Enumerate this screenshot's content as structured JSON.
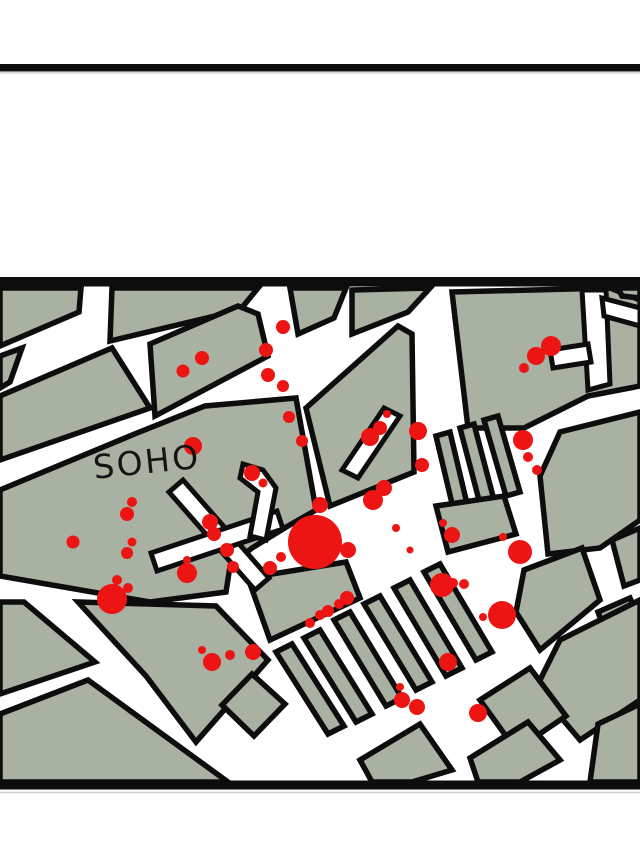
{
  "page": {
    "width": 640,
    "height": 853,
    "background": "#ffffff"
  },
  "colors": {
    "block_fill": "#a9b1a3",
    "outline": "#0d0d0d",
    "street": "#ffffff",
    "death_dot": "#ed1414",
    "rule_shadow": "#cccccc",
    "label_text": "#141414"
  },
  "rules": [
    {
      "name": "page-top-rule",
      "x": 0,
      "y": 64,
      "w": 640,
      "h": 7.5,
      "color": "#0d0d0d"
    },
    {
      "name": "page-top-rule-shadow",
      "x": 0,
      "y": 72.2,
      "w": 640,
      "h": 1.3,
      "color": "#cccccc"
    },
    {
      "name": "map-top-border",
      "x": 0,
      "y": 277,
      "w": 640,
      "h": 9.5,
      "color": "#0d0d0d"
    },
    {
      "name": "map-bottom-border",
      "x": 0,
      "y": 780.5,
      "w": 640,
      "h": 9,
      "color": "#0d0d0d"
    },
    {
      "name": "map-bottom-border-shadow",
      "x": 0,
      "y": 791.8,
      "w": 640,
      "h": 1.4,
      "color": "#cccccc"
    }
  ],
  "map": {
    "label": {
      "text": "SOHO",
      "x": 93,
      "y": 474,
      "font_size": 33,
      "rotation": -6,
      "rotate_cx": 140,
      "rotate_cy": 462
    },
    "block_stroke_width": 5.5,
    "street_stroke_width": 5,
    "blocks": [
      [
        [
          0,
          288
        ],
        [
          81,
          288
        ],
        [
          79,
          312
        ],
        [
          0,
          346
        ]
      ],
      [
        [
          0,
          356
        ],
        [
          22,
          348
        ],
        [
          10,
          382
        ],
        [
          0,
          388
        ]
      ],
      [
        [
          112,
          288
        ],
        [
          258,
          288
        ],
        [
          240,
          310
        ],
        [
          110,
          341
        ]
      ],
      [
        [
          290,
          288
        ],
        [
          346,
          288
        ],
        [
          334,
          318
        ],
        [
          298,
          334
        ]
      ],
      [
        [
          352,
          290
        ],
        [
          430,
          288
        ],
        [
          408,
          312
        ],
        [
          352,
          334
        ]
      ],
      [
        [
          452,
          292
        ],
        [
          610,
          288
        ],
        [
          640,
          300
        ],
        [
          640,
          386
        ],
        [
          588,
          396
        ],
        [
          524,
          428
        ],
        [
          468,
          428
        ]
      ],
      [
        [
          618,
          288
        ],
        [
          640,
          288
        ],
        [
          640,
          298
        ],
        [
          622,
          296
        ]
      ],
      [
        [
          0,
          396
        ],
        [
          112,
          348
        ],
        [
          150,
          408
        ],
        [
          0,
          460
        ]
      ],
      [
        [
          150,
          344
        ],
        [
          238,
          306
        ],
        [
          258,
          314
        ],
        [
          268,
          356
        ],
        [
          155,
          416
        ]
      ],
      [
        [
          306,
          408
        ],
        [
          398,
          326
        ],
        [
          412,
          334
        ],
        [
          414,
          472
        ],
        [
          330,
          506
        ]
      ],
      [
        [
          0,
          490
        ],
        [
          137,
          433
        ],
        [
          205,
          406
        ],
        [
          296,
          398
        ],
        [
          316,
          510
        ],
        [
          288,
          526
        ],
        [
          252,
          548
        ],
        [
          230,
          566
        ],
        [
          226,
          592
        ],
        [
          150,
          602
        ],
        [
          0,
          576
        ]
      ],
      [
        [
          436,
          436
        ],
        [
          450,
          432
        ],
        [
          468,
          508
        ],
        [
          454,
          512
        ]
      ],
      [
        [
          460,
          428
        ],
        [
          474,
          424
        ],
        [
          494,
          500
        ],
        [
          480,
          504
        ]
      ],
      [
        [
          484,
          420
        ],
        [
          498,
          416
        ],
        [
          520,
          492
        ],
        [
          506,
          496
        ]
      ],
      [
        [
          540,
          476
        ],
        [
          560,
          432
        ],
        [
          640,
          412
        ],
        [
          640,
          520
        ],
        [
          600,
          548
        ],
        [
          548,
          554
        ]
      ],
      [
        [
          612,
          540
        ],
        [
          640,
          528
        ],
        [
          640,
          580
        ],
        [
          624,
          586
        ]
      ],
      [
        [
          524,
          570
        ],
        [
          582,
          548
        ],
        [
          600,
          600
        ],
        [
          540,
          650
        ],
        [
          516,
          612
        ]
      ],
      [
        [
          598,
          612
        ],
        [
          630,
          598
        ],
        [
          640,
          620
        ],
        [
          612,
          650
        ]
      ],
      [
        [
          436,
          506
        ],
        [
          504,
          496
        ],
        [
          516,
          534
        ],
        [
          448,
          552
        ]
      ],
      [
        [
          248,
          578
        ],
        [
          346,
          562
        ],
        [
          360,
          598
        ],
        [
          270,
          640
        ]
      ],
      [
        [
          276,
          652
        ],
        [
          292,
          644
        ],
        [
          344,
          726
        ],
        [
          328,
          734
        ]
      ],
      [
        [
          304,
          638
        ],
        [
          320,
          630
        ],
        [
          372,
          714
        ],
        [
          356,
          722
        ]
      ],
      [
        [
          334,
          620
        ],
        [
          350,
          612
        ],
        [
          402,
          698
        ],
        [
          386,
          706
        ]
      ],
      [
        [
          364,
          604
        ],
        [
          380,
          596
        ],
        [
          432,
          682
        ],
        [
          416,
          690
        ]
      ],
      [
        [
          394,
          588
        ],
        [
          410,
          580
        ],
        [
          462,
          668
        ],
        [
          446,
          676
        ]
      ],
      [
        [
          424,
          572
        ],
        [
          440,
          564
        ],
        [
          492,
          652
        ],
        [
          476,
          660
        ]
      ],
      [
        [
          0,
          602
        ],
        [
          24,
          602
        ],
        [
          95,
          662
        ],
        [
          0,
          694
        ]
      ],
      [
        [
          78,
          602
        ],
        [
          216,
          606
        ],
        [
          268,
          660
        ],
        [
          196,
          742
        ],
        [
          146,
          676
        ]
      ],
      [
        [
          252,
          674
        ],
        [
          285,
          704
        ],
        [
          254,
          736
        ],
        [
          222,
          705
        ]
      ],
      [
        [
          0,
          714
        ],
        [
          88,
          680
        ],
        [
          228,
          782
        ],
        [
          0,
          782
        ]
      ],
      [
        [
          560,
          640
        ],
        [
          640,
          600
        ],
        [
          640,
          700
        ],
        [
          580,
          740
        ],
        [
          536,
          688
        ]
      ],
      [
        [
          480,
          700
        ],
        [
          530,
          668
        ],
        [
          566,
          716
        ],
        [
          516,
          750
        ]
      ],
      [
        [
          360,
          760
        ],
        [
          420,
          724
        ],
        [
          452,
          770
        ],
        [
          412,
          782
        ],
        [
          372,
          782
        ]
      ],
      [
        [
          470,
          758
        ],
        [
          528,
          722
        ],
        [
          560,
          760
        ],
        [
          520,
          782
        ],
        [
          478,
          782
        ]
      ],
      [
        [
          598,
          724
        ],
        [
          640,
          704
        ],
        [
          640,
          782
        ],
        [
          590,
          782
        ]
      ]
    ],
    "street_overlays": [
      [
        [
          183,
          480
        ],
        [
          269,
          578
        ],
        [
          255,
          590
        ],
        [
          169,
          492
        ]
      ],
      [
        [
          151,
          553
        ],
        [
          277,
          511
        ],
        [
          283,
          529
        ],
        [
          157,
          571
        ]
      ],
      [
        [
          243,
          464
        ],
        [
          263,
          470
        ],
        [
          276,
          488
        ],
        [
          266,
          540
        ],
        [
          250,
          536
        ],
        [
          258,
          492
        ],
        [
          240,
          478
        ]
      ],
      [
        [
          582,
          290
        ],
        [
          606,
          290
        ],
        [
          610,
          384
        ],
        [
          588,
          390
        ]
      ],
      [
        [
          550,
          350
        ],
        [
          588,
          344
        ],
        [
          591,
          362
        ],
        [
          553,
          368
        ]
      ],
      [
        [
          602,
          298
        ],
        [
          640,
          308
        ],
        [
          640,
          326
        ],
        [
          604,
          316
        ]
      ],
      [
        [
          342,
          470
        ],
        [
          384,
          408
        ],
        [
          400,
          416
        ],
        [
          358,
          478
        ]
      ]
    ],
    "dots": [
      [
        183,
        371,
        6.5
      ],
      [
        202,
        358,
        7
      ],
      [
        283,
        327,
        7
      ],
      [
        266,
        350,
        7
      ],
      [
        268,
        375,
        7
      ],
      [
        283,
        386,
        6
      ],
      [
        289,
        417,
        6
      ],
      [
        302,
        441,
        6
      ],
      [
        551,
        346,
        10
      ],
      [
        536,
        356,
        9
      ],
      [
        524,
        368,
        5
      ],
      [
        523,
        440,
        10
      ],
      [
        528,
        457,
        5
      ],
      [
        537,
        470,
        5
      ],
      [
        370,
        437,
        9
      ],
      [
        380,
        428,
        7
      ],
      [
        387,
        414,
        4
      ],
      [
        418,
        431,
        9
      ],
      [
        422,
        465,
        7
      ],
      [
        193,
        446,
        9
      ],
      [
        252,
        473,
        8
      ],
      [
        263,
        483,
        4.5
      ],
      [
        132,
        502,
        5
      ],
      [
        127,
        514,
        7
      ],
      [
        73,
        542,
        6.5
      ],
      [
        132,
        542,
        4.5
      ],
      [
        127,
        553,
        6
      ],
      [
        117,
        580,
        5
      ],
      [
        128,
        588,
        5
      ],
      [
        112,
        599,
        15
      ],
      [
        187,
        573,
        10
      ],
      [
        187,
        560,
        4
      ],
      [
        210,
        522,
        8
      ],
      [
        214,
        534,
        7
      ],
      [
        227,
        550,
        7
      ],
      [
        233,
        567,
        6
      ],
      [
        315,
        542,
        27
      ],
      [
        320,
        505,
        8
      ],
      [
        270,
        568,
        7
      ],
      [
        281,
        557,
        5
      ],
      [
        348,
        550,
        8
      ],
      [
        373,
        500,
        10
      ],
      [
        384,
        488,
        8
      ],
      [
        396,
        528,
        4
      ],
      [
        410,
        550,
        3.5
      ],
      [
        347,
        598,
        7
      ],
      [
        339,
        604,
        5
      ],
      [
        328,
        611,
        6
      ],
      [
        320,
        615,
        5
      ],
      [
        310,
        623,
        5
      ],
      [
        443,
        523,
        4
      ],
      [
        452,
        535,
        8
      ],
      [
        503,
        537,
        4
      ],
      [
        520,
        552,
        12
      ],
      [
        442,
        585,
        12
      ],
      [
        453,
        583,
        5
      ],
      [
        464,
        584,
        5
      ],
      [
        502,
        615,
        14
      ],
      [
        483,
        617,
        4
      ],
      [
        202,
        650,
        4
      ],
      [
        212,
        662,
        9
      ],
      [
        230,
        655,
        5
      ],
      [
        253,
        652,
        8
      ],
      [
        400,
        687,
        4
      ],
      [
        402,
        700,
        8
      ],
      [
        417,
        707,
        8
      ],
      [
        448,
        662,
        9
      ],
      [
        478,
        713,
        9
      ]
    ]
  }
}
